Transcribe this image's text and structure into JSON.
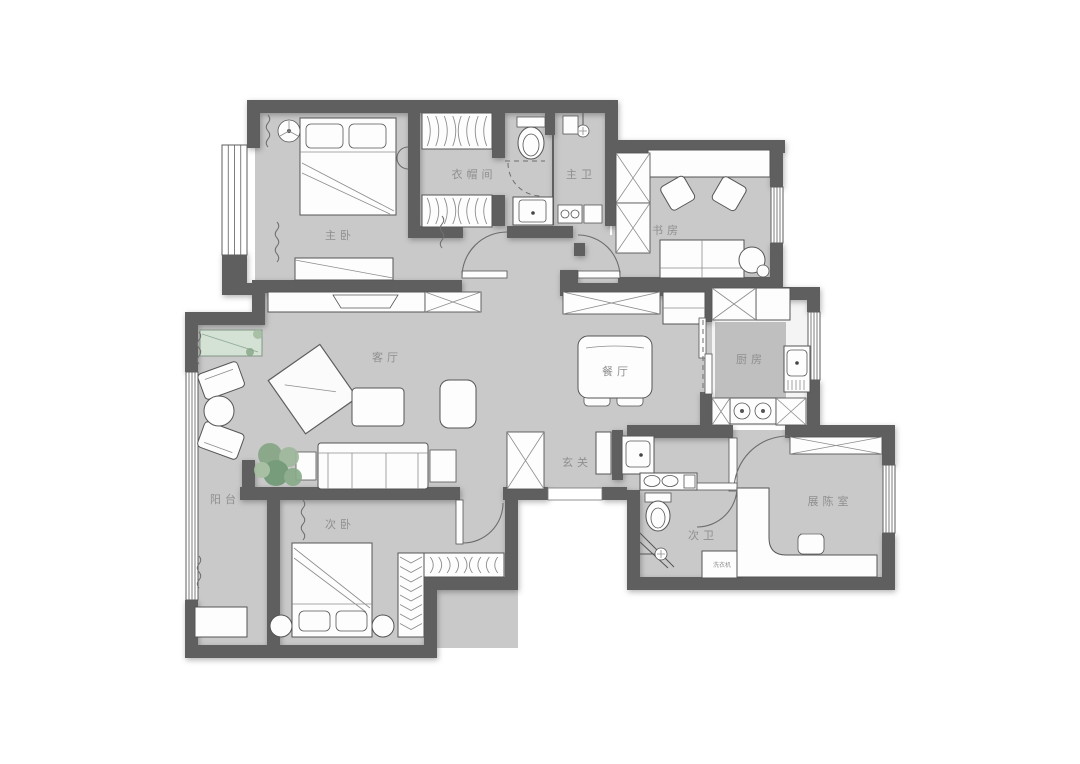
{
  "plan": {
    "rooms": [
      {
        "id": "master-bedroom",
        "label": "主卧"
      },
      {
        "id": "cloakroom",
        "label": "衣帽间"
      },
      {
        "id": "master-bathroom",
        "label": "主卫"
      },
      {
        "id": "study",
        "label": "书房"
      },
      {
        "id": "living-room",
        "label": "客厅"
      },
      {
        "id": "dining-room",
        "label": "餐厅"
      },
      {
        "id": "kitchen",
        "label": "厨房"
      },
      {
        "id": "entryway",
        "label": "玄关"
      },
      {
        "id": "balcony",
        "label": "阳台"
      },
      {
        "id": "second-bedroom",
        "label": "次卧"
      },
      {
        "id": "second-bathroom",
        "label": "次卫"
      },
      {
        "id": "display-room",
        "label": "展陈室"
      }
    ],
    "appliances": [
      {
        "id": "washing-machine",
        "label": "洗衣机"
      }
    ],
    "colors": {
      "background": "#ffffff",
      "floor": "#c9c9c9",
      "wall": "#5e5e5e",
      "outline": "#555555",
      "furniture": "#fdfdfd",
      "kitchen_island": "#bfbfbf",
      "plant_green": "#7fa080",
      "bench_green": "#d3e2d4",
      "label_text": "#8f8f8f"
    }
  }
}
